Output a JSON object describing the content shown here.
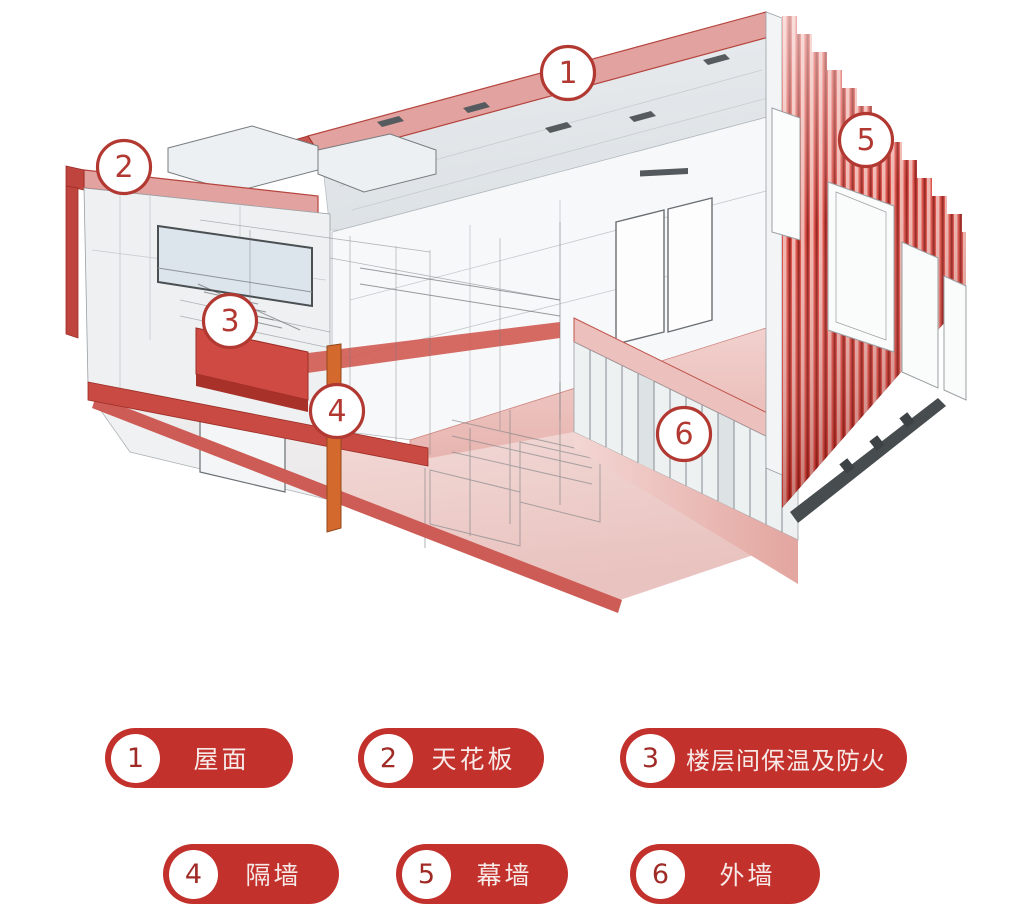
{
  "page": {
    "background": "#ffffff"
  },
  "colors": {
    "pill_red": "#C3312C",
    "marker_ring_red": "#B23832",
    "marker_number_red": "#A02B26",
    "legend_text": "#F7E9E7",
    "curtain_wall_red": "#C22A20",
    "slab_cut_red": "#C84A42",
    "roof_fascia_pink": "#E2A29F",
    "partition_orange": "#D4692E",
    "floor_pink": "#F0D2CF"
  },
  "diagram": {
    "title": "building-cutaway-axonometric",
    "markers": [
      {
        "number": "1"
      },
      {
        "number": "2"
      },
      {
        "number": "3"
      },
      {
        "number": "4"
      },
      {
        "number": "5"
      },
      {
        "number": "6"
      }
    ]
  },
  "legend": {
    "items": [
      {
        "number": "1",
        "label": "屋面"
      },
      {
        "number": "2",
        "label": "天花板"
      },
      {
        "number": "3",
        "label": "楼层间保温及防火"
      },
      {
        "number": "4",
        "label": "隔墙"
      },
      {
        "number": "5",
        "label": "幕墙"
      },
      {
        "number": "6",
        "label": "外墙"
      }
    ]
  }
}
